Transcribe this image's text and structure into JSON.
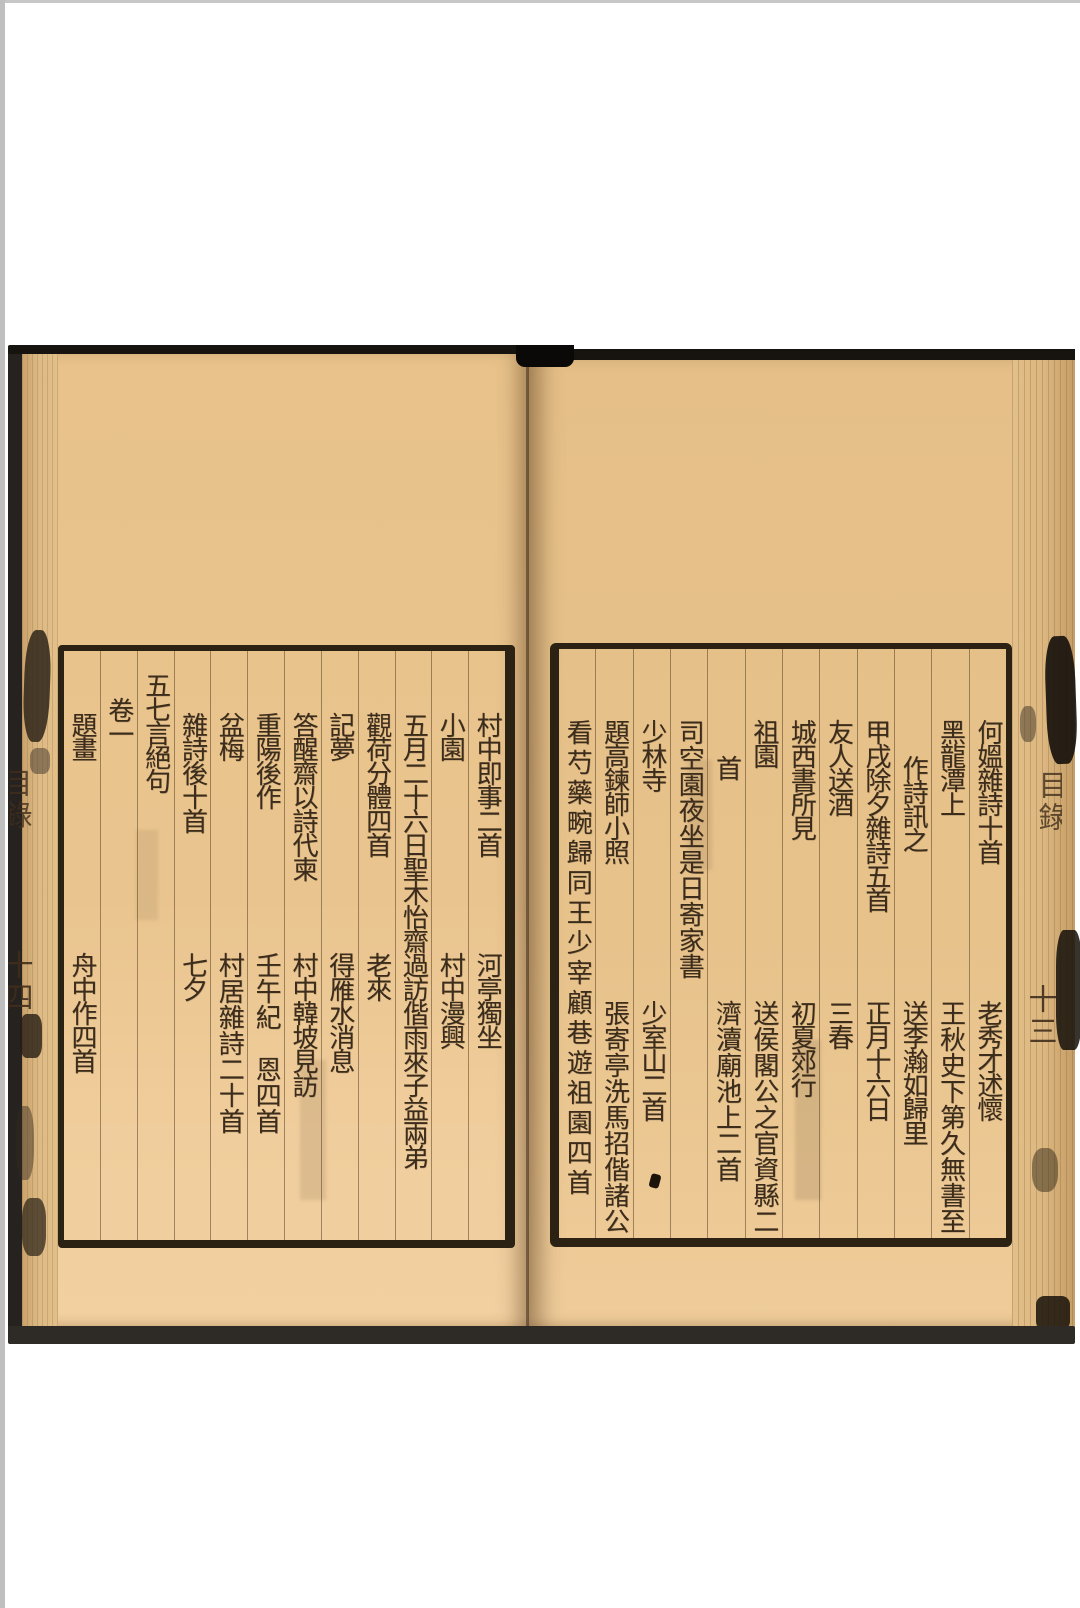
{
  "colors": {
    "paper": "#e8c28a",
    "ink": "#3b2c1b",
    "frame": "#2b2213",
    "cover_edge": "#262220",
    "viewer_background": "#ffffff"
  },
  "book": {
    "right_page": {
      "edge_title": "目錄",
      "edge_page_number": "十三",
      "columns": [
        {
          "t": "何媼雜詩十首",
          "b": "老秀才述懷"
        },
        {
          "t": "黑龍潭上",
          "b": "王秋史下第久無書至"
        },
        {
          "t": "作詩訊之",
          "b": "送李瀚如歸里"
        },
        {
          "t": "甲戌除夕雜詩五首",
          "b": "正月十六日"
        },
        {
          "t": "友人送酒",
          "b": "三春"
        },
        {
          "t": "城西書所見",
          "b": "初夏郊行"
        },
        {
          "t": "祖園",
          "b": "送侯閣公之官資縣二"
        },
        {
          "t": "首",
          "b": "濟瀆廟池上二首"
        },
        {
          "t": "司空園夜坐是日寄家書",
          "b": ""
        },
        {
          "t": "少林寺",
          "b": "少室山二首"
        },
        {
          "t": "題高鍊師小照",
          "b": "張寄亭洗馬招偕諸公"
        },
        {
          "t": "看芍藥畹歸同王少宰顧巷遊祖園四首",
          "b": ""
        }
      ]
    },
    "left_page": {
      "edge_title": "目錄",
      "edge_page_number": "十四",
      "columns": [
        {
          "t": "村中即事二首",
          "b": "河亭獨坐"
        },
        {
          "t": "小園",
          "b": "村中漫興"
        },
        {
          "t": "五月二十六日聖木怡齋過訪偕雨來子益兩弟",
          "b": ""
        },
        {
          "t": "觀荷分體四首",
          "b": "老來"
        },
        {
          "t": "記夢",
          "b": "得雁水消息"
        },
        {
          "t": "答醒齋以詩代柬",
          "b": "村中韓坡見訪"
        },
        {
          "t": "重陽後作",
          "b": "壬午紀　恩四首"
        },
        {
          "t": "盆梅",
          "b": "村居雜詩二十首"
        },
        {
          "t": "雜詩後十首",
          "b": "七夕"
        },
        {
          "t": "五七言絕句",
          "b": ""
        },
        {
          "t": "卷一",
          "b": ""
        },
        {
          "t": "題畫",
          "b": "舟中作四首"
        }
      ]
    }
  }
}
